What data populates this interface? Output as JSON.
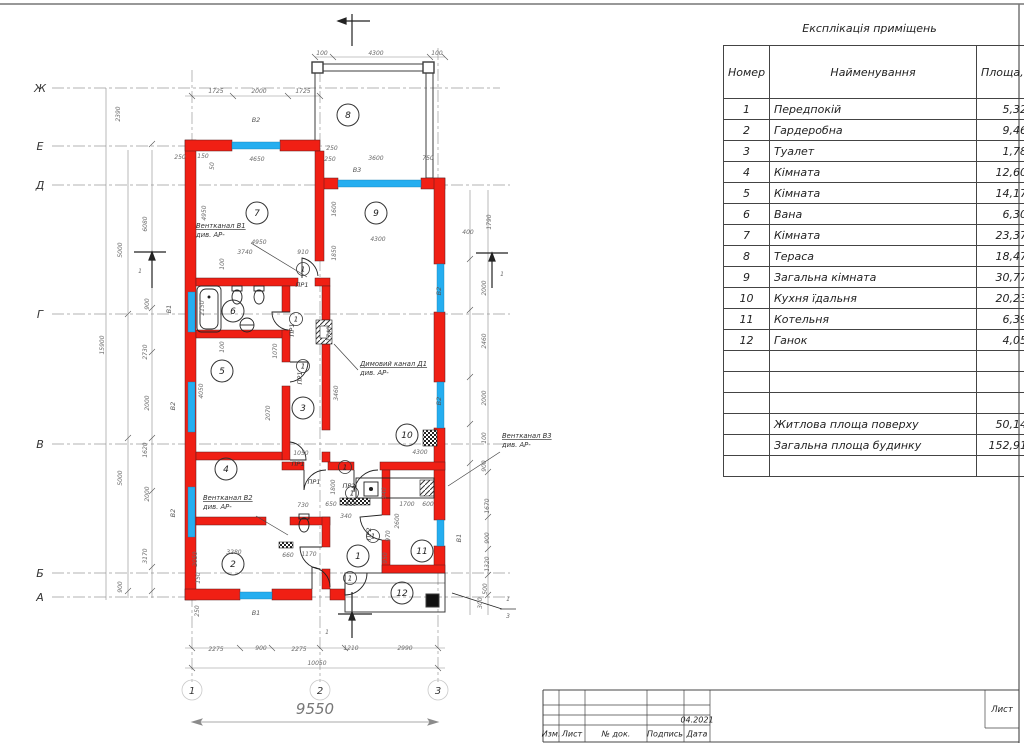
{
  "explication": {
    "title": "Експлікація приміщень",
    "columns": {
      "num": "Номер прим.",
      "name": "Найменування",
      "area": "Площа, м2"
    },
    "rows": [
      {
        "num": "1",
        "name": "Передпокій",
        "area": "5,32"
      },
      {
        "num": "2",
        "name": "Гардеробна",
        "area": "9,46"
      },
      {
        "num": "3",
        "name": "Туалет",
        "area": "1,78"
      },
      {
        "num": "4",
        "name": "Кімната",
        "area": "12,60"
      },
      {
        "num": "5",
        "name": "Кімната",
        "area": "14,17"
      },
      {
        "num": "6",
        "name": "Вана",
        "area": "6,30"
      },
      {
        "num": "7",
        "name": "Кімната",
        "area": "23,37"
      },
      {
        "num": "8",
        "name": "Тераса",
        "area": "18,47"
      },
      {
        "num": "9",
        "name": "Загальна кімната",
        "area": "30,77"
      },
      {
        "num": "10",
        "name": "Кухня їдальня",
        "area": "20,23"
      },
      {
        "num": "11",
        "name": "Котельня",
        "area": "6,39"
      },
      {
        "num": "12",
        "name": "Ганок",
        "area": "4,05"
      }
    ],
    "empty_rows": 3,
    "summary": [
      {
        "name": "Житлова площа поверху",
        "area": "50,14"
      },
      {
        "name": "Загальна площа будинку",
        "area": "152,91"
      }
    ],
    "trailing_empty_rows": 1
  },
  "title_block": {
    "labels": [
      "Изм.",
      "Лист",
      "№ док.",
      "Подпись",
      "Дата"
    ],
    "date": "04.2021",
    "sheet_label": "Лист"
  },
  "plan": {
    "colors": {
      "wall": "#f01f14",
      "window": "#25aef0",
      "line": "#3c3c3c"
    },
    "overall_dim": "9550",
    "axis_letters": [
      {
        "t": "Ж",
        "y": 88
      },
      {
        "t": "Е",
        "y": 146
      },
      {
        "t": "Д",
        "y": 185
      },
      {
        "t": "Г",
        "y": 314
      },
      {
        "t": "В",
        "y": 444
      },
      {
        "t": "Б",
        "y": 573
      },
      {
        "t": "А",
        "y": 597
      }
    ],
    "axis_numbers": [
      {
        "t": "1",
        "x": 192
      },
      {
        "t": "2",
        "x": 320
      },
      {
        "t": "3",
        "x": 438
      }
    ],
    "rooms": [
      {
        "n": "1",
        "x": 358,
        "y": 556
      },
      {
        "n": "2",
        "x": 233,
        "y": 564
      },
      {
        "n": "3",
        "x": 303,
        "y": 408
      },
      {
        "n": "4",
        "x": 226,
        "y": 469
      },
      {
        "n": "5",
        "x": 222,
        "y": 371
      },
      {
        "n": "6",
        "x": 233,
        "y": 311
      },
      {
        "n": "7",
        "x": 257,
        "y": 213
      },
      {
        "n": "8",
        "x": 348,
        "y": 115
      },
      {
        "n": "9",
        "x": 376,
        "y": 213
      },
      {
        "n": "10",
        "x": 407,
        "y": 435
      },
      {
        "n": "11",
        "x": 422,
        "y": 551
      },
      {
        "n": "12",
        "x": 402,
        "y": 593
      }
    ],
    "door_marks": [
      {
        "t": "1",
        "x": 303,
        "y": 269
      },
      {
        "t": "1",
        "x": 296,
        "y": 319
      },
      {
        "t": "1",
        "x": 303,
        "y": 366
      },
      {
        "t": "1",
        "x": 345,
        "y": 467
      },
      {
        "t": "1",
        "x": 352,
        "y": 493
      },
      {
        "t": "1",
        "x": 373,
        "y": 536
      },
      {
        "t": "1",
        "x": 350,
        "y": 578
      }
    ],
    "door_labels": [
      {
        "t": "ПР1",
        "x": 302,
        "y": 287
      },
      {
        "t": "ПР1",
        "x": 294,
        "y": 330,
        "r": 1
      },
      {
        "t": "ПР1",
        "x": 302,
        "y": 378,
        "r": 1
      },
      {
        "t": "ПР1",
        "x": 298,
        "y": 466
      },
      {
        "t": "ПР1",
        "x": 314,
        "y": 484
      },
      {
        "t": "ПР2",
        "x": 349,
        "y": 488
      },
      {
        "t": "ПР2",
        "x": 371,
        "y": 534,
        "r": 1
      }
    ],
    "window_labels": [
      {
        "t": "В2",
        "x": 256,
        "y": 122
      },
      {
        "t": "В3",
        "x": 357,
        "y": 172
      },
      {
        "t": "В1",
        "x": 171,
        "y": 309,
        "r": 1
      },
      {
        "t": "В2",
        "x": 175,
        "y": 406,
        "r": 1
      },
      {
        "t": "В2",
        "x": 175,
        "y": 513,
        "r": 1
      },
      {
        "t": "В2",
        "x": 441,
        "y": 291,
        "r": 1
      },
      {
        "t": "В2",
        "x": 441,
        "y": 401,
        "r": 1
      },
      {
        "t": "В1",
        "x": 461,
        "y": 538,
        "r": 1
      },
      {
        "t": "В1",
        "x": 256,
        "y": 615
      }
    ],
    "dims": [
      {
        "t": "100",
        "x": 322,
        "y": 55
      },
      {
        "t": "4300",
        "x": 376,
        "y": 55
      },
      {
        "t": "100",
        "x": 437,
        "y": 55
      },
      {
        "t": "1725",
        "x": 216,
        "y": 93
      },
      {
        "t": "2000",
        "x": 259,
        "y": 93
      },
      {
        "t": "1725",
        "x": 303,
        "y": 93
      },
      {
        "t": "2390",
        "x": 120,
        "y": 114,
        "r": 1
      },
      {
        "t": "250",
        "x": 180,
        "y": 159
      },
      {
        "t": "150",
        "x": 203,
        "y": 158
      },
      {
        "t": "50",
        "x": 214,
        "y": 166,
        "r": 1
      },
      {
        "t": "4650",
        "x": 257,
        "y": 161
      },
      {
        "t": "250",
        "x": 332,
        "y": 150
      },
      {
        "t": "250",
        "x": 330,
        "y": 161
      },
      {
        "t": "3600",
        "x": 376,
        "y": 160
      },
      {
        "t": "750",
        "x": 428,
        "y": 160
      },
      {
        "t": "6080",
        "x": 147,
        "y": 224,
        "r": 1
      },
      {
        "t": "5000",
        "x": 122,
        "y": 250,
        "r": 1
      },
      {
        "t": "900",
        "x": 149,
        "y": 304,
        "r": 1
      },
      {
        "t": "15900",
        "x": 104,
        "y": 345,
        "r": 1
      },
      {
        "t": "2730",
        "x": 147,
        "y": 352,
        "r": 1
      },
      {
        "t": "2000",
        "x": 149,
        "y": 403,
        "r": 1
      },
      {
        "t": "5000",
        "x": 122,
        "y": 478,
        "r": 1
      },
      {
        "t": "1620",
        "x": 147,
        "y": 450,
        "r": 1
      },
      {
        "t": "2000",
        "x": 149,
        "y": 494,
        "r": 1
      },
      {
        "t": "3170",
        "x": 147,
        "y": 556,
        "r": 1
      },
      {
        "t": "900",
        "x": 122,
        "y": 587,
        "r": 1
      },
      {
        "t": "400",
        "x": 468,
        "y": 234
      },
      {
        "t": "1790",
        "x": 491,
        "y": 222,
        "r": 1
      },
      {
        "t": "2000",
        "x": 486,
        "y": 288,
        "r": 1
      },
      {
        "t": "2460",
        "x": 486,
        "y": 341,
        "r": 1
      },
      {
        "t": "2000",
        "x": 486,
        "y": 398,
        "r": 1
      },
      {
        "t": "100",
        "x": 486,
        "y": 438,
        "r": 1
      },
      {
        "t": "900",
        "x": 486,
        "y": 466,
        "r": 1
      },
      {
        "t": "1670",
        "x": 489,
        "y": 506,
        "r": 1
      },
      {
        "t": "900",
        "x": 489,
        "y": 538,
        "r": 1
      },
      {
        "t": "1320",
        "x": 489,
        "y": 564,
        "r": 1
      },
      {
        "t": "500",
        "x": 487,
        "y": 589,
        "r": 1
      },
      {
        "t": "300",
        "x": 482,
        "y": 603,
        "r": 1
      },
      {
        "t": "250",
        "x": 199,
        "y": 611,
        "r": 1
      },
      {
        "t": "2275",
        "x": 216,
        "y": 651
      },
      {
        "t": "900",
        "x": 261,
        "y": 650
      },
      {
        "t": "2275",
        "x": 299,
        "y": 651
      },
      {
        "t": "1210",
        "x": 351,
        "y": 650
      },
      {
        "t": "2990",
        "x": 405,
        "y": 650
      },
      {
        "t": "10050",
        "x": 317,
        "y": 665
      },
      {
        "t": "4950",
        "x": 259,
        "y": 244
      },
      {
        "t": "3740",
        "x": 245,
        "y": 254
      },
      {
        "t": "910",
        "x": 303,
        "y": 254
      },
      {
        "t": "4950",
        "x": 206,
        "y": 213,
        "r": 1
      },
      {
        "t": "100",
        "x": 224,
        "y": 264,
        "r": 1
      },
      {
        "t": "1600",
        "x": 336,
        "y": 209,
        "r": 1
      },
      {
        "t": "4300",
        "x": 378,
        "y": 241
      },
      {
        "t": "1850",
        "x": 336,
        "y": 253,
        "r": 1
      },
      {
        "t": "2150",
        "x": 204,
        "y": 308,
        "r": 1
      },
      {
        "t": "4050",
        "x": 203,
        "y": 391,
        "r": 1
      },
      {
        "t": "100",
        "x": 224,
        "y": 347,
        "r": 1
      },
      {
        "t": "1070",
        "x": 277,
        "y": 351,
        "r": 1
      },
      {
        "t": "2070",
        "x": 270,
        "y": 413,
        "r": 1
      },
      {
        "t": "3460",
        "x": 338,
        "y": 393,
        "r": 1
      },
      {
        "t": "1740",
        "x": 331,
        "y": 334,
        "r": 1
      },
      {
        "t": "1050",
        "x": 301,
        "y": 455
      },
      {
        "t": "4300",
        "x": 420,
        "y": 454
      },
      {
        "t": "1800",
        "x": 335,
        "y": 487,
        "r": 1
      },
      {
        "t": "940",
        "x": 386,
        "y": 493,
        "r": 1
      },
      {
        "t": "730",
        "x": 303,
        "y": 507
      },
      {
        "t": "650",
        "x": 331,
        "y": 506
      },
      {
        "t": "910",
        "x": 351,
        "y": 506
      },
      {
        "t": "340",
        "x": 346,
        "y": 518
      },
      {
        "t": "1700",
        "x": 407,
        "y": 506
      },
      {
        "t": "600",
        "x": 428,
        "y": 506
      },
      {
        "t": "2600",
        "x": 399,
        "y": 521,
        "r": 1
      },
      {
        "t": "970",
        "x": 390,
        "y": 536,
        "r": 1
      },
      {
        "t": "950",
        "x": 387,
        "y": 558,
        "r": 1
      },
      {
        "t": "3280",
        "x": 234,
        "y": 554
      },
      {
        "t": "2050",
        "x": 197,
        "y": 559,
        "r": 1
      },
      {
        "t": "150",
        "x": 200,
        "y": 578,
        "r": 1
      },
      {
        "t": "660",
        "x": 288,
        "y": 557
      },
      {
        "t": "1170",
        "x": 309,
        "y": 556
      },
      {
        "t": "1",
        "x": 140,
        "y": 273
      },
      {
        "t": "1",
        "x": 502,
        "y": 276
      },
      {
        "t": "1",
        "x": 327,
        "y": 634
      },
      {
        "t": "1",
        "x": 508,
        "y": 601
      },
      {
        "t": "3",
        "x": 508,
        "y": 618
      }
    ],
    "annotations": [
      {
        "l1": "Вентканал В1",
        "l2": "див. АР-",
        "x": 196,
        "y": 228,
        "lx1": 251,
        "ly1": 243,
        "lx2": 307,
        "ly2": 277
      },
      {
        "l1": "Вентканал В2",
        "l2": "див. АР-",
        "x": 203,
        "y": 500,
        "lx1": 256,
        "ly1": 516,
        "lx2": 288,
        "ly2": 535
      },
      {
        "l1": "Вентканал В3",
        "l2": "див. АР-",
        "x": 502,
        "y": 438,
        "lx1": 500,
        "ly1": 452,
        "lx2": 448,
        "ly2": 486
      },
      {
        "l1": "Димовий канал Д1",
        "l2": "див. АР-",
        "x": 360,
        "y": 366,
        "lx1": 358,
        "ly1": 370,
        "lx2": 334,
        "ly2": 344
      }
    ]
  }
}
